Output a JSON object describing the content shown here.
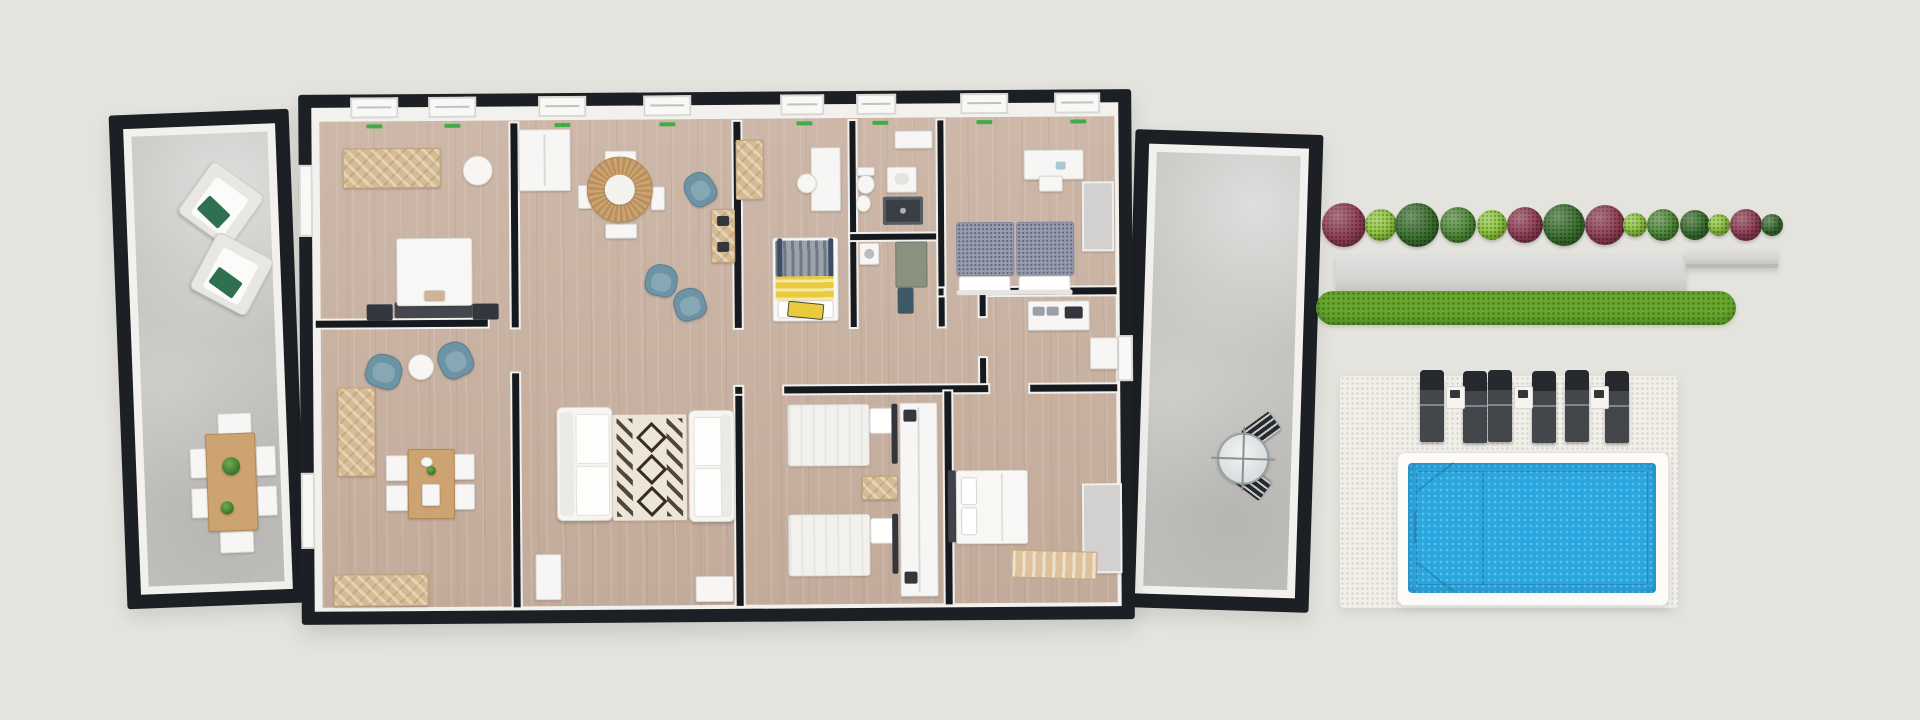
{
  "scene": {
    "description": "Top-down 3D architectural render: rectangular house with black walls flanked by two concrete patios, plus a hedge planter, grass strip, six sun loungers and a swimming pool on the right",
    "background": "#e4e3dd"
  },
  "colors": {
    "bg": "#e4e3dd",
    "frame": "#1c1f24",
    "wall": "#16191d",
    "lining": "#f2f1ee",
    "wood": "#c9b2a2",
    "concrete": "#c4c3c0",
    "paving": "#f0efe9",
    "pavingDot": "#d7d5c9",
    "water": "#2ba7e0",
    "poolRim": "#fcfbf8",
    "grass": "#68a72f",
    "bushMaroon": "#8f3e54",
    "bushLight": "#8fc83e",
    "bushMid": "#4f8a38",
    "bushDark": "#3a6f2e",
    "planter": "#d8d7d5",
    "planterShadow": "#bab9b6",
    "furnWhite": "#f7f6f4",
    "furnBorder": "#d8d6d1",
    "woodFurn": "#d6bb92",
    "woodTable": "#cda371",
    "woodTableDark": "#b08954",
    "darkFurn": "#33373d",
    "blueChair": "#6d94a5",
    "blueChairDark": "#597f90",
    "yellow": "#e9cb3d",
    "duvetGray": "#989eb0",
    "loungerBody": "#43474c",
    "loungerDark": "#26292d",
    "greenPillow": "#2f7050",
    "greenTick": "#3fae4a",
    "rugBase": "#ece6d8",
    "rugPattern": "#3b2a1e",
    "sage": "#8a927f",
    "teal": "#3f5a67",
    "benchTan": "#ddc29c",
    "closetGray": "#d2d1cf"
  },
  "left_patio": {
    "floor": "concrete",
    "furniture": [
      "armchair",
      "armchair",
      "outdoor-dining-table",
      "dining-chair",
      "dining-chair",
      "dining-chair",
      "dining-chair",
      "dining-chair",
      "dining-chair",
      "potted-plant",
      "potted-plant"
    ]
  },
  "house": {
    "rooms": [
      "bedroom-top-left",
      "study-dining-room",
      "living-dining-room",
      "kids-bunk-room",
      "bathroom",
      "utility-room",
      "bedroom-top-right",
      "kitchen",
      "hallway",
      "twin-bedroom",
      "double-bedroom"
    ]
  },
  "right_patio": {
    "floor": "concrete",
    "furniture": [
      "bistro-table",
      "bistro-chair",
      "bistro-chair"
    ]
  },
  "hedge": {
    "cy": 225,
    "bushes": [
      {
        "cx": 1344,
        "r": 22,
        "color": "bushMaroon"
      },
      {
        "cx": 1381,
        "r": 16,
        "color": "bushLight"
      },
      {
        "cx": 1417,
        "r": 22,
        "color": "bushDark"
      },
      {
        "cx": 1458,
        "r": 18,
        "color": "bushMid"
      },
      {
        "cx": 1492,
        "r": 15,
        "color": "bushLight"
      },
      {
        "cx": 1525,
        "r": 18,
        "color": "bushMaroon"
      },
      {
        "cx": 1564,
        "r": 21,
        "color": "bushDark"
      },
      {
        "cx": 1605,
        "r": 20,
        "color": "bushMaroon"
      },
      {
        "cx": 1635,
        "r": 12,
        "color": "bushLight"
      },
      {
        "cx": 1663,
        "r": 16,
        "color": "bushMid"
      },
      {
        "cx": 1695,
        "r": 15,
        "color": "bushDark"
      },
      {
        "cx": 1719,
        "r": 11,
        "color": "bushLight"
      },
      {
        "cx": 1746,
        "r": 16,
        "color": "bushMaroon"
      },
      {
        "cx": 1772,
        "r": 11,
        "color": "bushDark"
      }
    ],
    "planter_box": [
      1336,
      255,
      350,
      38
    ],
    "planter_ledge": [
      1686,
      250,
      92,
      14
    ],
    "grass_strip": [
      1316,
      291,
      420,
      34
    ]
  },
  "pool_area": {
    "paving": [
      1340,
      376,
      338,
      232
    ],
    "loungers": {
      "y": 378,
      "width": 24,
      "height": 64,
      "x": [
        1420,
        1463,
        1488,
        1532,
        1565,
        1605
      ]
    },
    "side_tables": {
      "y": 386,
      "width": 17,
      "height": 21,
      "x": [
        1446,
        1514,
        1590
      ]
    },
    "pool": {
      "rim": [
        1397,
        452,
        270,
        152
      ],
      "water": [
        1408,
        463,
        248,
        130
      ]
    }
  }
}
